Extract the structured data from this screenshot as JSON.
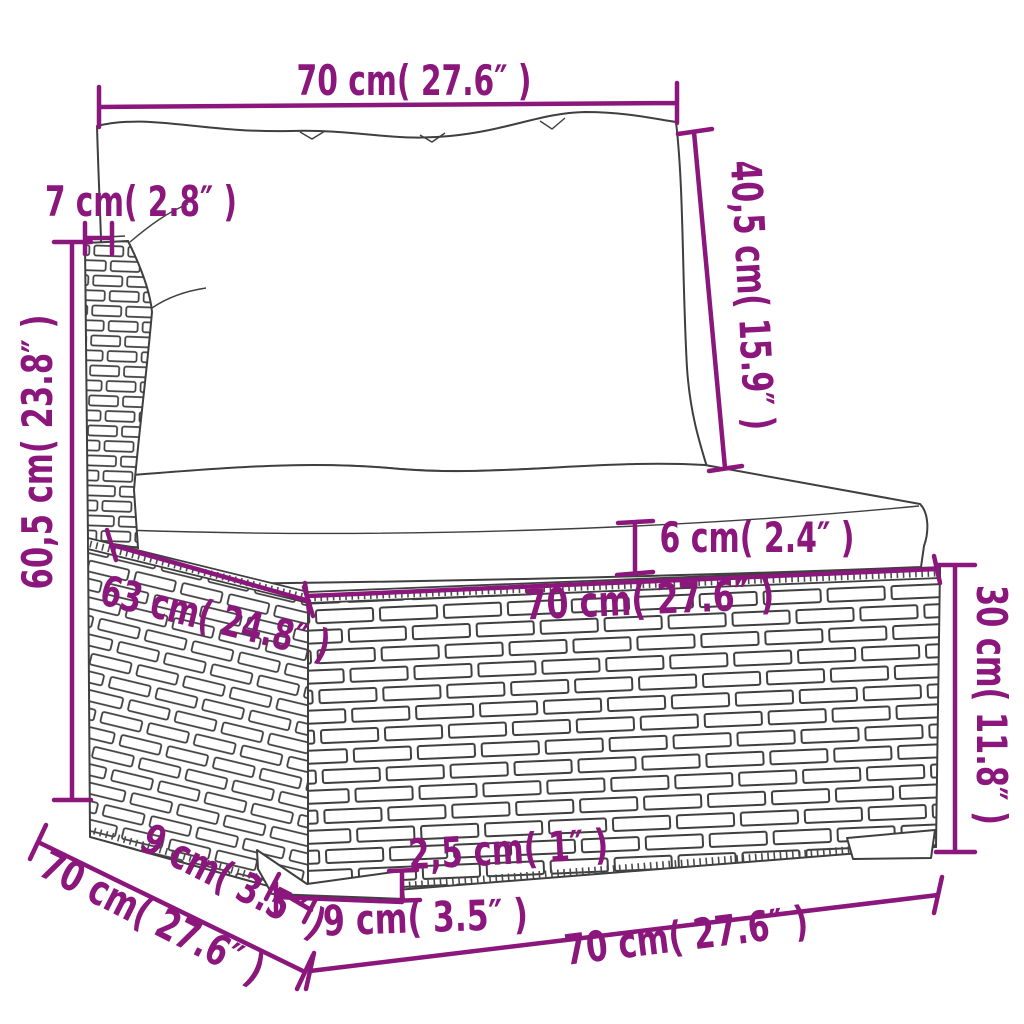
{
  "meta": {
    "type": "product-dimension-diagram",
    "subject": "poly rattan garden sofa middle section with back and seat cushions"
  },
  "style": {
    "accent_color": "#8B177C",
    "line_color": "#3F3F3F",
    "background_color": "#FFFFFF"
  },
  "labels": {
    "top_width": "70 cm( 27.6″ )",
    "backrest_depth": "7 cm( 2.8″ )",
    "backrest_height": "40,5 cm( 15.9″ )",
    "total_height": "60,5 cm( 23.8″ )",
    "cushion_thickness": "6 cm( 2.4″ )",
    "seat_width": "70 cm( 27.6″ )",
    "seat_depth": "63 cm( 24.8″ )",
    "base_height": "30 cm( 11.8″ )",
    "foot_height": "2,5 cm( 1″ )",
    "foot_width": "9 cm( 3.5″ )",
    "foot_depth": "9 cm( 3.5″ )",
    "base_width": "70 cm( 27.6″ )"
  }
}
